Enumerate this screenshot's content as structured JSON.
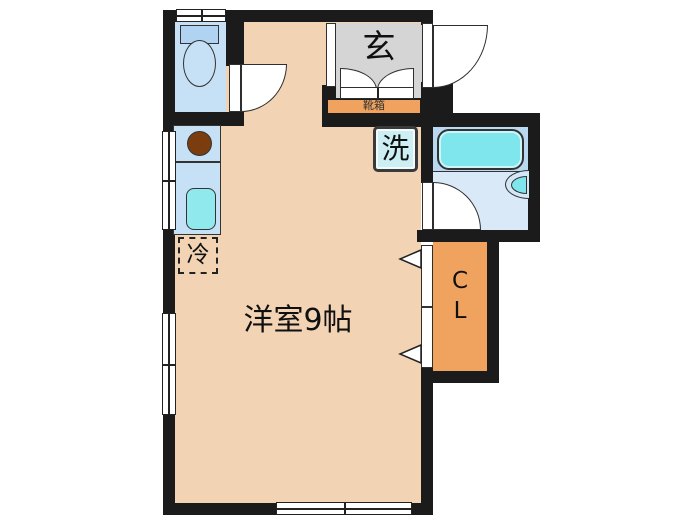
{
  "floorplan": {
    "room_label": "洋室9帖",
    "entrance_label": "玄",
    "shoe_box_label": "靴箱",
    "washing_machine_label": "洗",
    "refrigerator_label": "冷",
    "closet_label_line1": "C",
    "closet_label_line2": "L",
    "colors": {
      "wall": "#1b1b1b",
      "room_floor": "#F2D4B5",
      "entrance_floor": "#D5D5D5",
      "accent_orange": "#F0A35E",
      "fixture_blue": "#C6E0F5",
      "bath_floor_upper": "#BAD9F1",
      "bath_floor_lower": "#DAE9F8",
      "tub_cyan": "#80E6EE",
      "sink_cyan": "#8FE9ED",
      "washer_fill": "#CDEFF3",
      "burner_brown": "#7C3D0E",
      "line": "#333333"
    }
  }
}
